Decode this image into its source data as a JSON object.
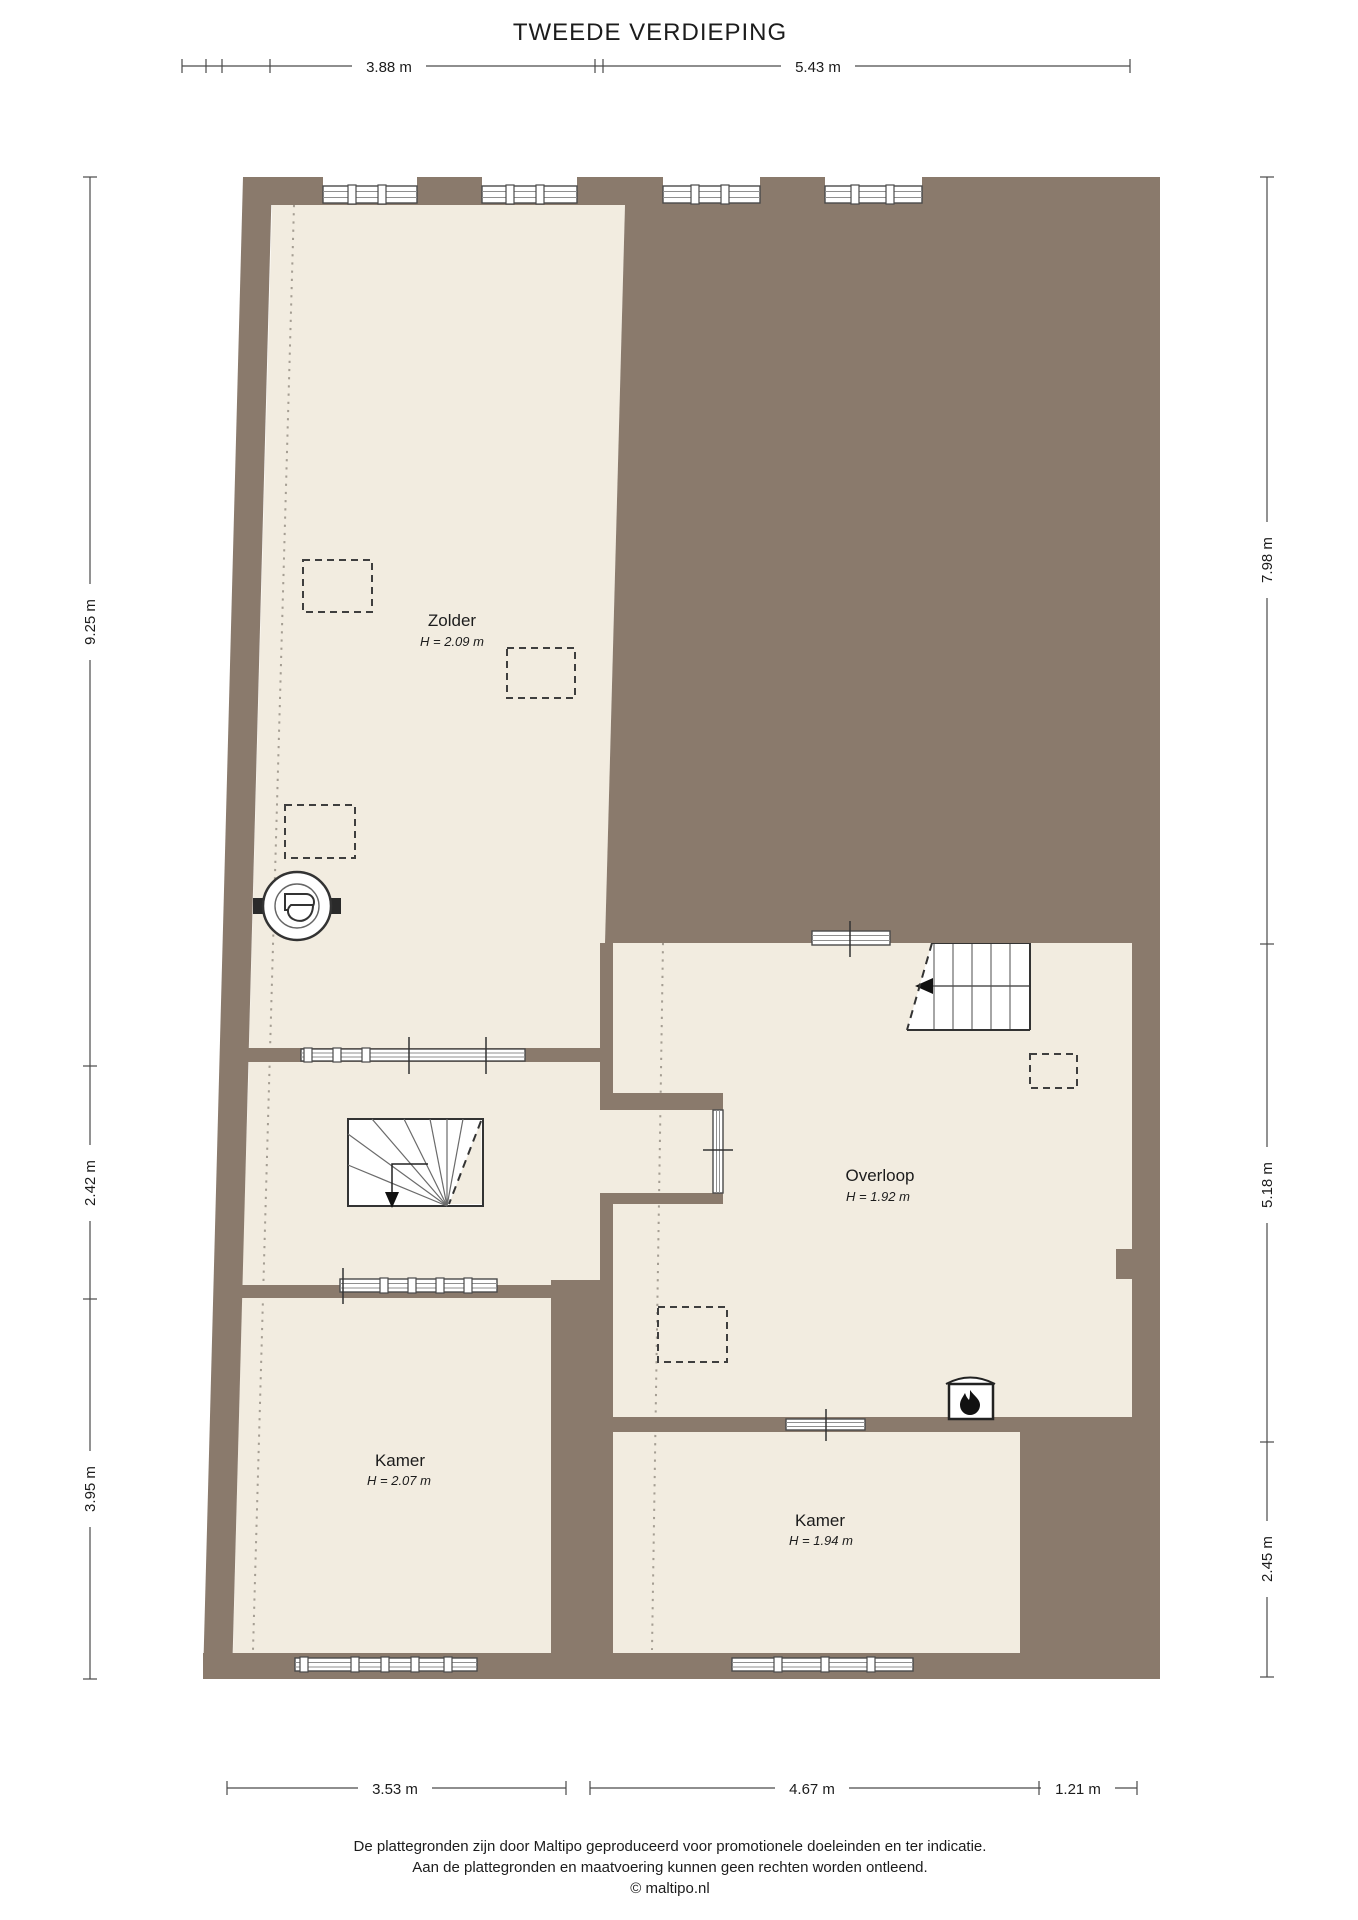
{
  "title": "TWEEDE VERDIEPING",
  "rooms": {
    "zolder": {
      "name": "Zolder",
      "height": "H = 2.09 m"
    },
    "overloop": {
      "name": "Overloop",
      "height": "H = 1.92 m"
    },
    "kamer_left": {
      "name": "Kamer",
      "height": "H = 2.07 m"
    },
    "kamer_right": {
      "name": "Kamer",
      "height": "H = 1.94 m"
    }
  },
  "dimensions": {
    "top": [
      "3.88 m",
      "5.43 m"
    ],
    "bottom": [
      "3.53 m",
      "4.67 m",
      "1.21 m"
    ],
    "left": [
      "9.25 m",
      "2.42 m",
      "3.95 m"
    ],
    "right": [
      "7.98 m",
      "5.18 m",
      "2.45 m"
    ]
  },
  "footer": [
    "De plattegronden zijn door Maltipo geproduceerd voor promotionele doeleinden en ter indicatie.",
    "Aan de plattegronden en maatvoering kunnen geen rechten worden ontleend.",
    "© maltipo.nl"
  ],
  "colors": {
    "wall": "#8a7a6c",
    "floor": "#f2ece0"
  }
}
